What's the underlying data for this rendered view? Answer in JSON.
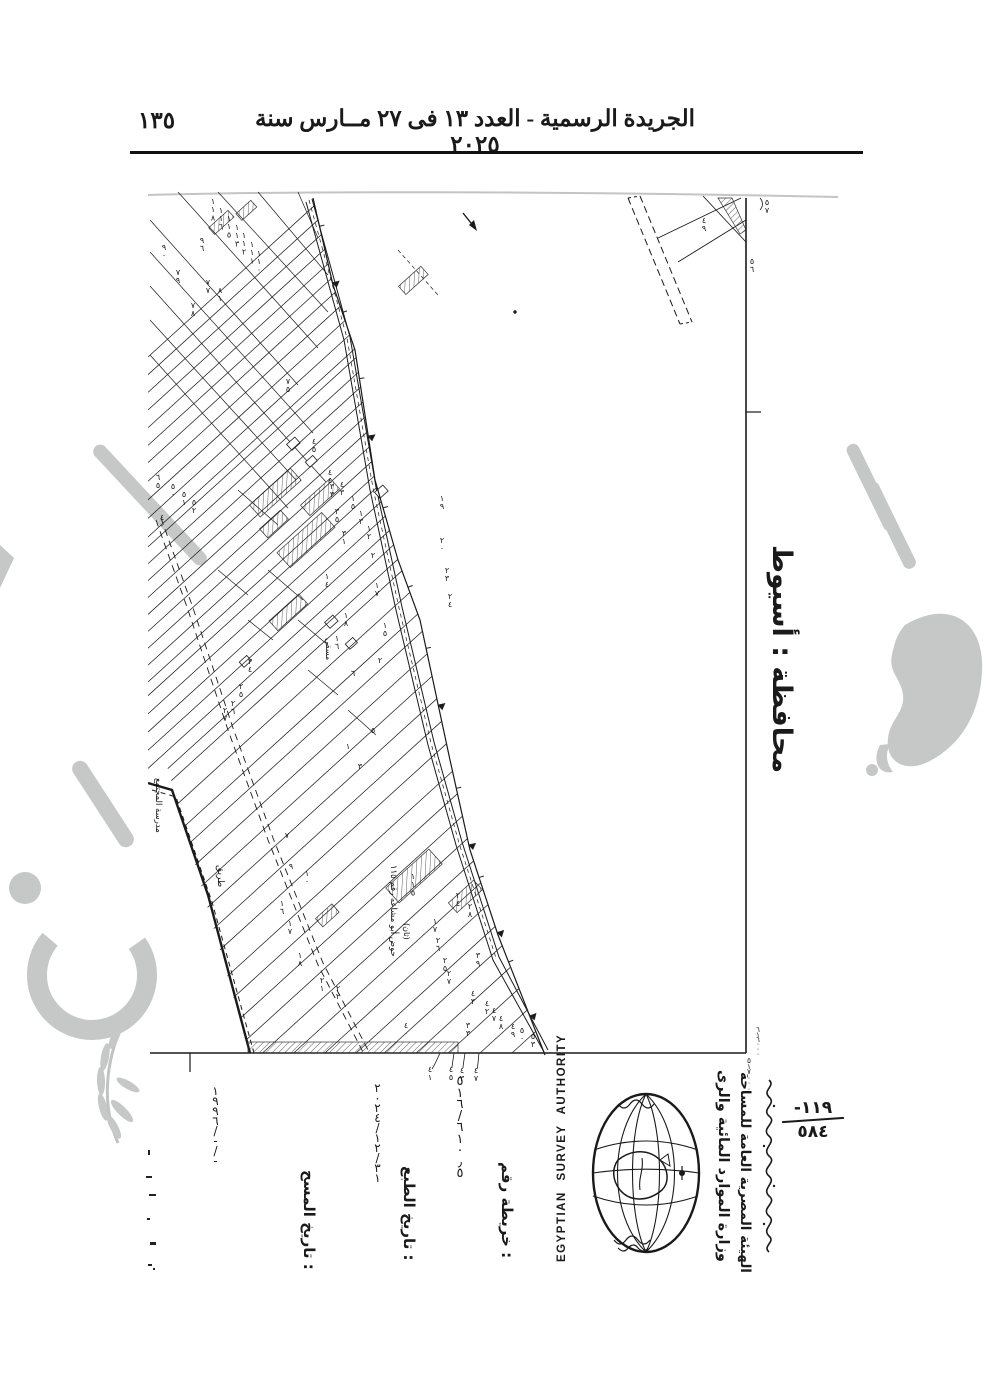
{
  "header": {
    "page_number": "١٣٥",
    "title": "الجريدة الرسمية - العدد ١٣ فى ٢٧ مــارس سنة ٢٠٢٥"
  },
  "governorate_label": "محافظة : أسيوط",
  "map_info": {
    "map_no_label": "خريطة رقم :",
    "map_no_value": "٥١٦/٦١٠٫٥",
    "print_date_label": "تاريخ الطبع :",
    "print_date_value": "٢٠٢٤/١٢/٣١",
    "survey_date_label": "تاريخ المسح :",
    "survey_date_value": "١٩٩٦/-/-"
  },
  "authority": {
    "name_en": "EGYPTIAN SURVEY AUTHORITY",
    "ministry_ar": "وزارة الموارد المائية والرى",
    "authority_ar": "الهيئة المصرية العامة للمساحة"
  },
  "stamp": {
    "dash": "-",
    "numerator": "١١٩",
    "denominator": "٥٨٤"
  },
  "grid_coords": {
    "right_edge": "٦١٦٠٠٠",
    "bottom_edge": "٥١٧٠٠٠"
  },
  "colors": {
    "ink": "#1a1a1a",
    "watermark": "#c5c8c7",
    "paper": "#ffffff"
  },
  "map": {
    "parcel_numbers": [
      [
        65,
        14,
        "١١٨"
      ],
      [
        73,
        23,
        "١١٦"
      ],
      [
        81,
        31,
        "١١٥"
      ],
      [
        89,
        40,
        "١١٣"
      ],
      [
        96,
        48,
        "١١٢"
      ],
      [
        104,
        57,
        "١١١"
      ],
      [
        111,
        66,
        "١١٠"
      ],
      [
        54,
        53,
        "٩٦"
      ],
      [
        16,
        60,
        "٩٠"
      ],
      [
        30,
        85,
        "٧٩"
      ],
      [
        60,
        95,
        "٧٧"
      ],
      [
        72,
        103,
        "٨١"
      ],
      [
        45,
        118,
        "٧٨"
      ],
      [
        140,
        194,
        "٧٥"
      ],
      [
        166,
        254,
        "٤٥"
      ],
      [
        182,
        285,
        "٤٤"
      ],
      [
        194,
        297,
        "٤٣"
      ],
      [
        205,
        311,
        "١٥"
      ],
      [
        213,
        326,
        "١٣"
      ],
      [
        221,
        341,
        "١٢"
      ],
      [
        10,
        290,
        "٦٥"
      ],
      [
        25,
        299,
        "٥٠"
      ],
      [
        36,
        307,
        "٥١"
      ],
      [
        46,
        315,
        "٥٢"
      ],
      [
        14,
        330,
        "٤٠"
      ],
      [
        102,
        474,
        "٢٤"
      ],
      [
        93,
        499,
        "٢٥"
      ],
      [
        85,
        516,
        "٢٦"
      ],
      [
        77,
        523,
        "٢٧"
      ],
      [
        184,
        299,
        "٣٣"
      ],
      [
        189,
        324,
        "٣٥"
      ],
      [
        196,
        346,
        "٣١"
      ],
      [
        225,
        368,
        "٢٠"
      ],
      [
        229,
        398,
        "١٧"
      ],
      [
        198,
        428,
        "١٨"
      ],
      [
        179,
        389,
        "١٤"
      ],
      [
        237,
        438,
        "١٥"
      ],
      [
        189,
        451,
        "١٦"
      ],
      [
        232,
        473,
        "٢"
      ],
      [
        205,
        486,
        "٦"
      ],
      [
        225,
        543,
        "٥"
      ],
      [
        200,
        559,
        "١"
      ],
      [
        212,
        579,
        "٣"
      ],
      [
        294,
        311,
        "١٩"
      ],
      [
        294,
        353,
        "٢٠"
      ],
      [
        299,
        383,
        "٢٣"
      ],
      [
        302,
        409,
        "٢٤"
      ],
      [
        139,
        648,
        "٧"
      ],
      [
        143,
        679,
        "٩"
      ],
      [
        159,
        686,
        "١٠"
      ],
      [
        134,
        716,
        "١٦"
      ],
      [
        142,
        736,
        "١٧"
      ],
      [
        152,
        768,
        "١٨"
      ],
      [
        174,
        793,
        "٢١"
      ],
      [
        190,
        801,
        "٢٢"
      ],
      [
        265,
        689,
        "١١٥"
      ],
      [
        310,
        708,
        "٢٤"
      ],
      [
        322,
        719,
        "٢٨"
      ],
      [
        287,
        734,
        "١٧"
      ],
      [
        290,
        753,
        "٢٦"
      ],
      [
        297,
        773,
        "٢٥"
      ],
      [
        301,
        786,
        "٢٧"
      ],
      [
        330,
        768,
        "٣٩"
      ],
      [
        325,
        806,
        "٤٣"
      ],
      [
        339,
        816,
        "٤٢"
      ],
      [
        346,
        823,
        "٤٧"
      ],
      [
        353,
        831,
        "٤٨"
      ],
      [
        365,
        839,
        "٤٩"
      ],
      [
        374,
        843,
        "٥٠"
      ],
      [
        385,
        849,
        "٥٣"
      ],
      [
        320,
        838,
        "٣٣"
      ],
      [
        258,
        838,
        "٤٠"
      ],
      [
        619,
        15,
        "٥٧"
      ],
      [
        604,
        74,
        "٥٦"
      ],
      [
        556,
        33,
        "٤٩"
      ],
      [
        282,
        882,
        "٤١"
      ],
      [
        303,
        882,
        "٤٥"
      ],
      [
        314,
        883,
        "٤٣"
      ],
      [
        328,
        883,
        "٤٧"
      ]
    ],
    "area_labels": [
      {
        "x": 8,
        "y": 588,
        "s": 8.5,
        "t": "مدرسة المجتمع"
      },
      {
        "x": 70,
        "y": 675,
        "s": 9,
        "t": "طريق"
      },
      {
        "x": 243,
        "y": 675,
        "s": 8.5,
        "t": "حوض أبو مشاعه رقم ١١٥"
      },
      {
        "x": 256,
        "y": 733,
        "s": 8,
        "t": "(ثان)"
      },
      {
        "x": 178,
        "y": 448,
        "s": 8,
        "t": "مسقى"
      }
    ]
  }
}
